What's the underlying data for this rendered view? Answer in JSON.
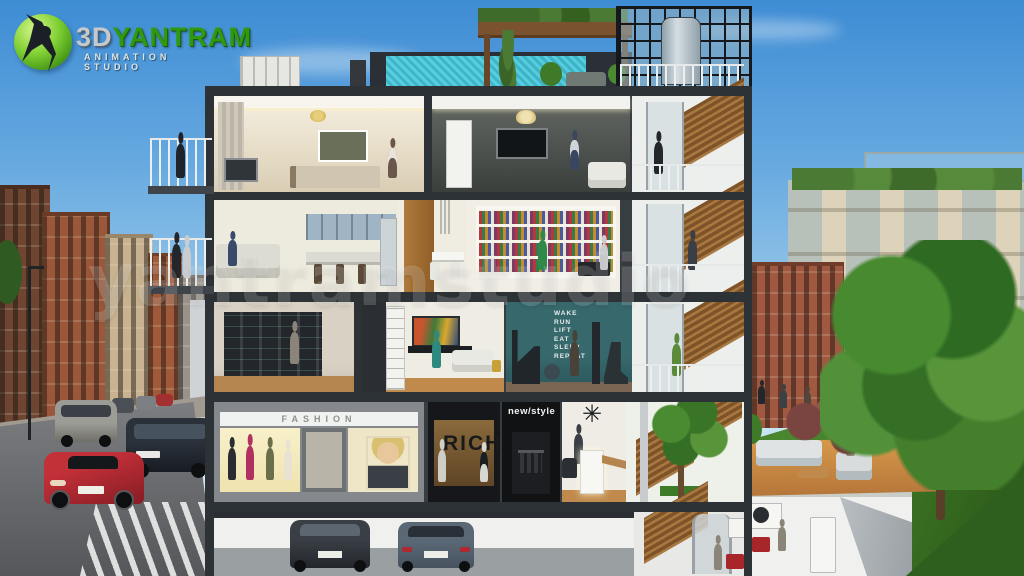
{
  "logo": {
    "brand_prefix": "3D",
    "brand_name": "YANTRAM",
    "subtitle": "ANIMATION STUDIO",
    "accent_color": "#2f9a10"
  },
  "watermark": {
    "text": "yantramstudio"
  },
  "storefronts": {
    "fashion_sign": "FASHION",
    "rich_sign": "RICH",
    "newstyle_sign": "new/style"
  },
  "gym_wall": {
    "lines": [
      "WAKE",
      "RUN",
      "LIFT",
      "EAT",
      "SLEEP",
      "REPEAT"
    ],
    "wall_color": "#2e5f63"
  },
  "palette": {
    "sky_top": "#3e8cd4",
    "sky_bottom": "#cde8f6",
    "pool_water": "#54c4d8",
    "lawn_green": "#3f7e28",
    "wood": "#b07a3c",
    "frame_dark": "#32373c",
    "brick": "#9a573a"
  }
}
